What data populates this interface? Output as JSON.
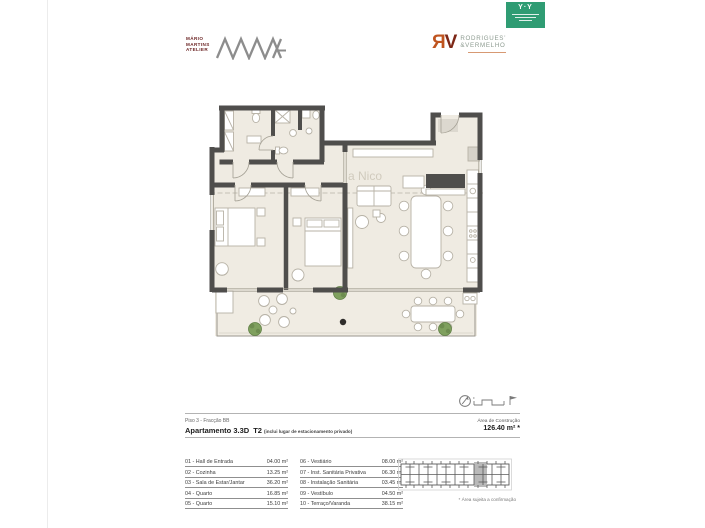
{
  "header": {
    "badge": {
      "mark": "Y·Y"
    },
    "mma": {
      "line1": "MÁRIO",
      "line2": "MARTINS",
      "line3": "ATELIER",
      "monogram": "MMA"
    },
    "rv": {
      "mark_r": "Я",
      "mark_v": "V",
      "line1": "RODRIGUES’",
      "line2": "&VERMELHO"
    }
  },
  "plan": {
    "watermark": "a Nico"
  },
  "info": {
    "floor_line": "Piso 3 - Fracção BB",
    "apartment": "Apartamento 3.3D",
    "type": "T2",
    "note": "(inclui lugar de estacionamento privado)",
    "area_label": "Área de Construção",
    "area_value": "126.40 m² *"
  },
  "rooms": {
    "left": [
      {
        "name": "01 - Hall de Entrada",
        "area": "04.00 m²"
      },
      {
        "name": "02 - Cozinha",
        "area": "13.25 m²"
      },
      {
        "name": "03 - Sala de Estar/Jantar",
        "area": "36.20 m²"
      },
      {
        "name": "04 - Quarto",
        "area": "16.85 m²"
      },
      {
        "name": "05 - Quarto",
        "area": "15.10 m²"
      }
    ],
    "right": [
      {
        "name": "06 - Vestiário",
        "area": "08.00 m²"
      },
      {
        "name": "07 - Inst. Sanitária Privativa",
        "area": "06.30 m²"
      },
      {
        "name": "08 - Instalação Sanitária",
        "area": "03.45 m²"
      },
      {
        "name": "09 - Vestíbulo",
        "area": "04.50 m²"
      },
      {
        "name": "10 - Terraço/Varanda",
        "area": "38.15 m²"
      }
    ]
  },
  "footnote": "* Área sujeita a confirmação",
  "colors": {
    "wall": "#4f4e4c",
    "floor": "#efebe2",
    "badge_green": "#2f9c73",
    "rv_orange": "#bf541f",
    "rv_darkred": "#7d2716",
    "plant_green": "#7fa05e"
  }
}
